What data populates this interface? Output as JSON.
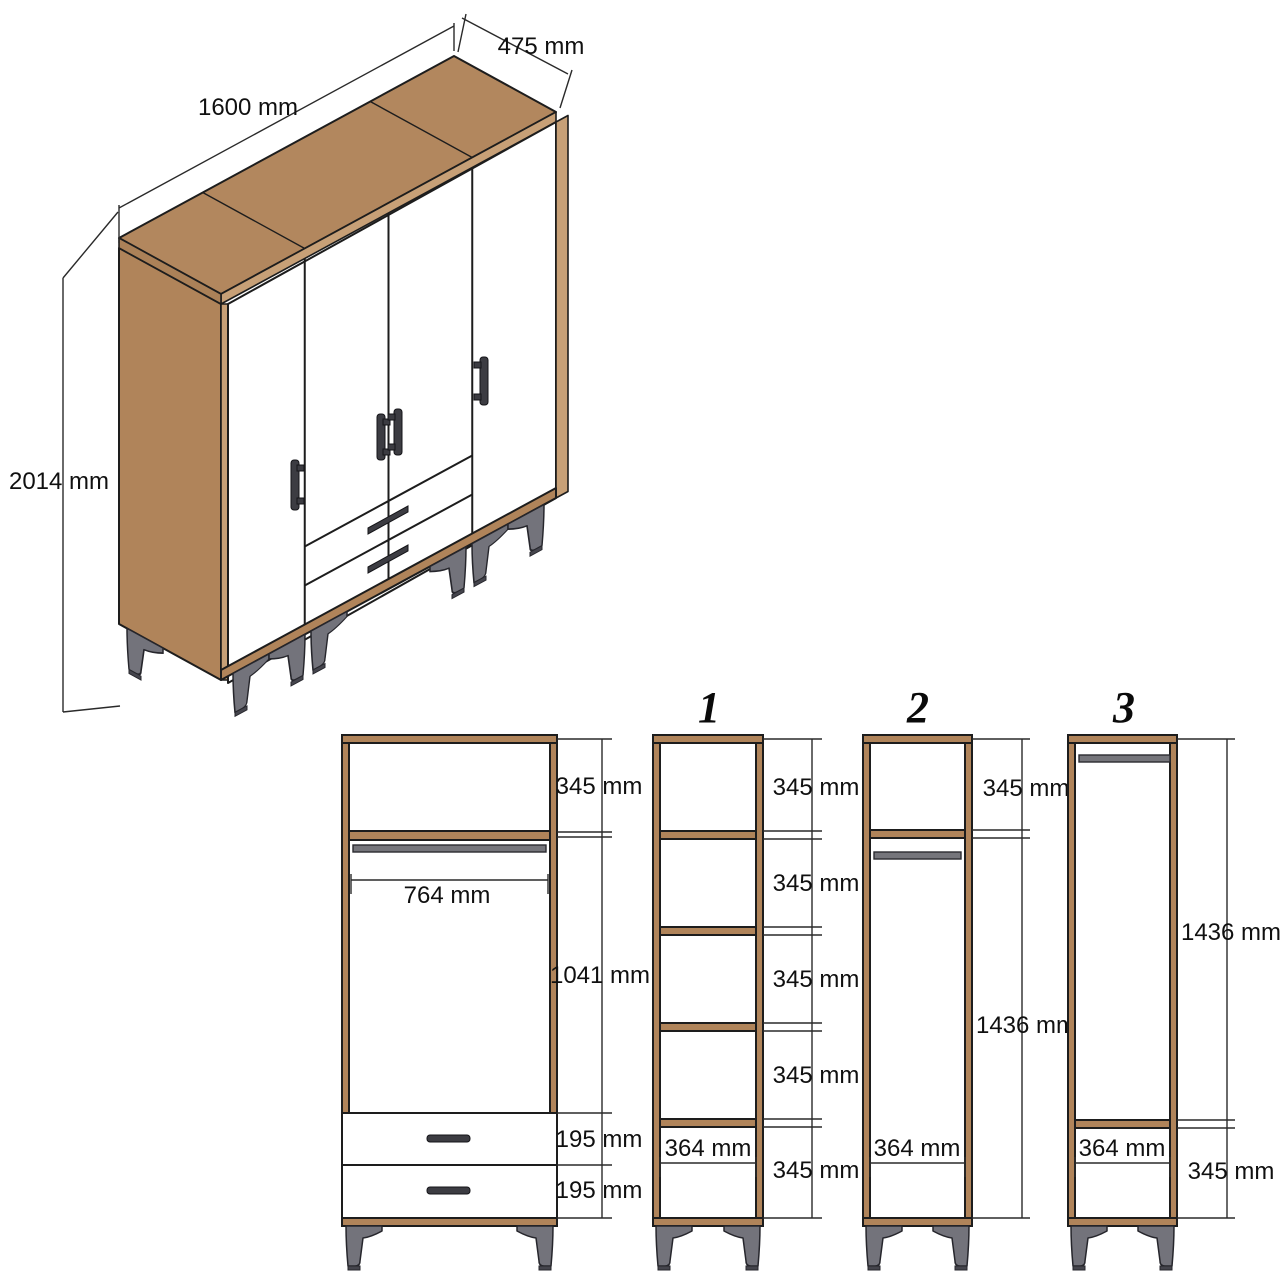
{
  "isometric": {
    "width_label": "1600 mm",
    "depth_label": "475 mm",
    "height_label": "2014 mm"
  },
  "main_view": {
    "top_compartment": "345 mm",
    "interior_width": "764 mm",
    "hanging_space": "1041 mm",
    "top_drawer": "195 mm",
    "bottom_drawer": "195 mm"
  },
  "section_1": {
    "number": "1",
    "compartments": [
      "345 mm",
      "345 mm",
      "345 mm",
      "345 mm",
      "345 mm"
    ],
    "interior_width": "364 mm"
  },
  "section_2": {
    "number": "2",
    "top_compartment": "345 mm",
    "open_space": "1436 mm",
    "interior_width": "364 mm"
  },
  "section_3": {
    "number": "3",
    "open_space": "1436 mm",
    "bottom_compartment": "345 mm",
    "interior_width": "364 mm"
  },
  "colors": {
    "background": "#ffffff",
    "wood": "#b0845a",
    "wood_top": "#b2875e",
    "wood_light": "#c7a077",
    "wood_mid": "#ab8158",
    "outline": "#1d1d1d",
    "dim_line": "#2a2a2a",
    "text": "#101010",
    "rail": "#75757b",
    "leg": "#73737b",
    "leg_dark": "#45454d",
    "handle": "#3c3c42"
  }
}
